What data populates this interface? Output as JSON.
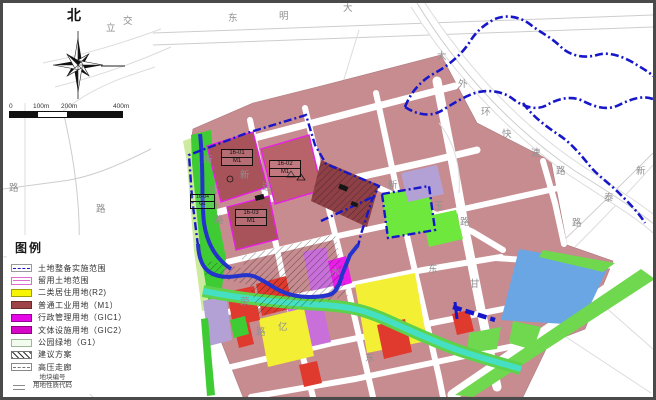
{
  "frame": {
    "border_color": "#4a4a4a"
  },
  "compass": {
    "label": "北"
  },
  "scale_bar": {
    "ticks": [
      "0",
      "100m",
      "200m",
      "400m"
    ]
  },
  "palette": {
    "boundary": "#1717c9",
    "river": "#2433cc",
    "stream": "#45e0c4",
    "streamedge": "#5ed24b",
    "rose": "#c78c90",
    "maroon": "#a8535a",
    "maroon2": "#b8626a",
    "maroondark": "#8e4046",
    "magenta": "#e81ee8",
    "yellow": "#f2ef35",
    "greenstrip": "#3ecb33",
    "greenbright": "#6ee83c",
    "greenband": "#6fd84e",
    "greenlight": "#cdeb9e",
    "violet": "#c86fd9",
    "lavender": "#b3a1d6",
    "red": "#e0392d",
    "blueparcel": "#6aa6e4"
  },
  "legend": {
    "title": "图例",
    "items": [
      {
        "label": "土地整备实施范围",
        "swatch": "boundary-line",
        "color": "#1717c9"
      },
      {
        "label": "留用土地范围",
        "swatch": "outline-magenta",
        "color": "#e06ad4"
      },
      {
        "label": "二类居住用地(R2)",
        "swatch": "fill",
        "color": "#f8f504"
      },
      {
        "label": "普通工业用地（M1）",
        "swatch": "fill",
        "color": "#9e4448"
      },
      {
        "label": "行政管理用地（GIC1）",
        "swatch": "fill",
        "color": "#e607e6"
      },
      {
        "label": "文体设施用地（GIC2）",
        "swatch": "fill",
        "color": "#d607c6"
      },
      {
        "label": "公园绿地（G1）",
        "swatch": "fill-outline",
        "color": "#f3faee"
      },
      {
        "label": "建议方案",
        "swatch": "hatch",
        "color": "#333333"
      },
      {
        "label": "高压走廊",
        "swatch": "dashed-box",
        "color": "#777777"
      },
      {
        "label": "地块编号／用地性质代码",
        "swatch": "code",
        "numerator": "地块编号",
        "denominator": "用地性质代码"
      }
    ]
  },
  "map": {
    "parcel_labels": [
      {
        "code": "16-01",
        "use": "M1"
      },
      {
        "code": "16-02",
        "use": "M1"
      },
      {
        "code": "16-03",
        "use": "M1"
      },
      {
        "code": "16-04",
        "use": "G1"
      }
    ],
    "road_chars": [
      {
        "ch": "东",
        "x": 225,
        "y": 18
      },
      {
        "ch": "明",
        "x": 276,
        "y": 16
      },
      {
        "ch": "大",
        "x": 340,
        "y": 8
      },
      {
        "ch": "大",
        "x": 434,
        "y": 56
      },
      {
        "ch": "外",
        "x": 455,
        "y": 84
      },
      {
        "ch": "环",
        "x": 478,
        "y": 112
      },
      {
        "ch": "快",
        "x": 499,
        "y": 134
      },
      {
        "ch": "速",
        "x": 528,
        "y": 153
      },
      {
        "ch": "路",
        "x": 553,
        "y": 171
      },
      {
        "ch": "立",
        "x": 103,
        "y": 28
      },
      {
        "ch": "交",
        "x": 120,
        "y": 21
      },
      {
        "ch": "新",
        "x": 200,
        "y": 160
      },
      {
        "ch": "拓",
        "x": 206,
        "y": 190
      },
      {
        "ch": "路",
        "x": 211,
        "y": 220
      },
      {
        "ch": "新",
        "x": 237,
        "y": 175
      },
      {
        "ch": "达",
        "x": 259,
        "y": 187
      },
      {
        "ch": "新",
        "x": 385,
        "y": 185
      },
      {
        "ch": "玉",
        "x": 431,
        "y": 206
      },
      {
        "ch": "路",
        "x": 457,
        "y": 222
      },
      {
        "ch": "新",
        "x": 633,
        "y": 171
      },
      {
        "ch": "泰",
        "x": 601,
        "y": 198
      },
      {
        "ch": "路",
        "x": 569,
        "y": 223
      },
      {
        "ch": "路",
        "x": 6,
        "y": 188
      },
      {
        "ch": "路",
        "x": 93,
        "y": 209
      },
      {
        "ch": "荣",
        "x": 237,
        "y": 302
      },
      {
        "ch": "路",
        "x": 253,
        "y": 332
      },
      {
        "ch": "亿",
        "x": 275,
        "y": 327
      },
      {
        "ch": "水",
        "x": 328,
        "y": 272
      },
      {
        "ch": "东",
        "x": 425,
        "y": 269
      },
      {
        "ch": "甘",
        "x": 467,
        "y": 284
      },
      {
        "ch": "东",
        "x": 362,
        "y": 358
      }
    ]
  }
}
